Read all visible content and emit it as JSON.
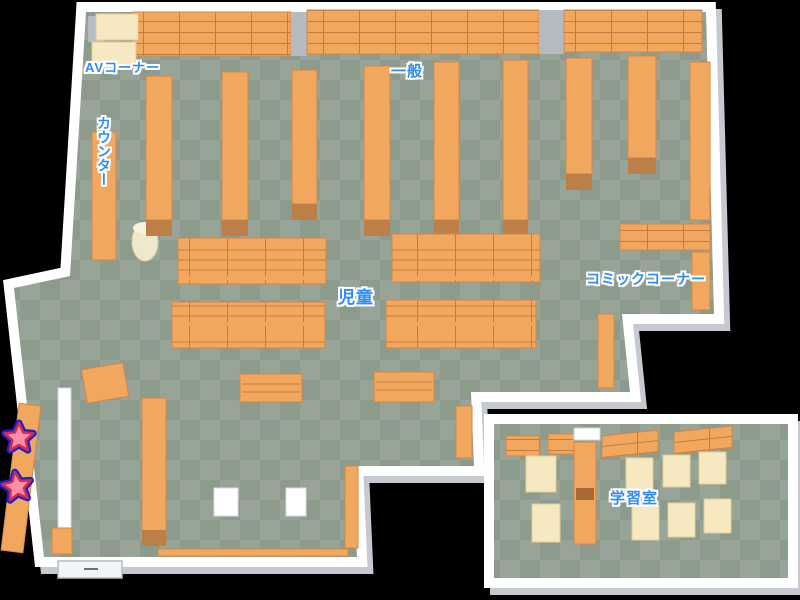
{
  "map_labels": {
    "av_corner": "AVコーナー",
    "general": "一般",
    "counter": "カウンター",
    "children": "児童",
    "comic_corner": "コミックコーナー",
    "study_room": "学習室"
  },
  "markers": {
    "stars": [
      {
        "id": "star-marker-1"
      },
      {
        "id": "star-marker-2"
      }
    ]
  },
  "colors": {
    "background": "#000000",
    "wall": "#ffffff",
    "wall_shadow": "#c6cad0",
    "floor_light": "#97a497",
    "floor_dark": "#8d9b8d",
    "shelf": "#f2a75f",
    "shelf_edge": "#d2874a",
    "shelf_dark": "#bd7f48",
    "shelf_line": "#c27c3f",
    "desk": "#f6e9c2",
    "desk_edge": "#e2cd96",
    "pillar": "#b6bac1",
    "cylinder": "#efe8cc",
    "label_blue": "#2e8cf2",
    "star_fill": "#fb8fa5",
    "star_ring": "#d82a50",
    "star_outline": "#2020c8"
  }
}
